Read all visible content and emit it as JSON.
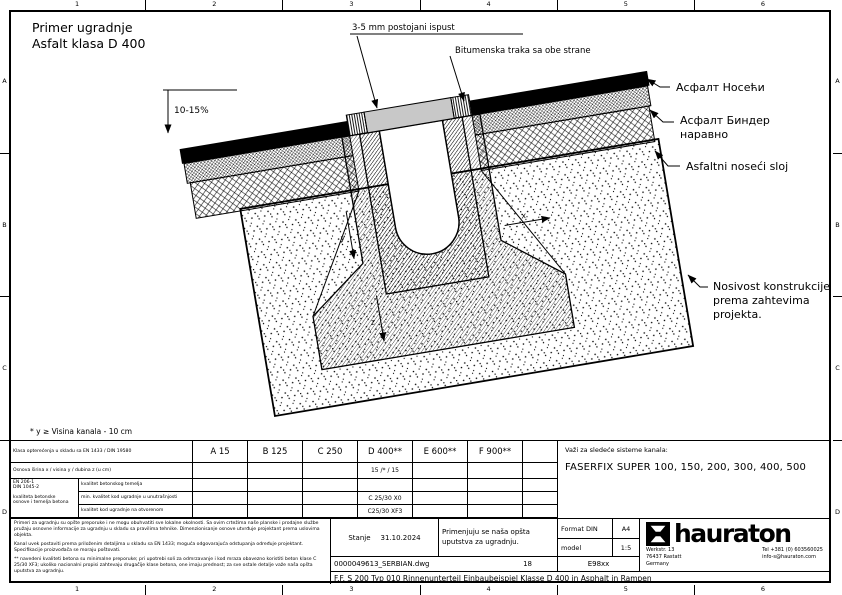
{
  "sheet": {
    "title_line1": "Primer ugradnje",
    "title_line2": "Asfalt klasa D 400",
    "footnote": "* y ≥ Visina kanala - 10 cm",
    "grid_columns": [
      "1",
      "2",
      "3",
      "4",
      "5",
      "6"
    ],
    "grid_rows": [
      "A",
      "B",
      "C",
      "D"
    ]
  },
  "annotations": {
    "expansion_gap": "3-5 mm postojani ispust",
    "bitumen_tape": "Bitumenska traka sa obe strane",
    "slope": "10-15%",
    "asphalt_surface": "Асфалт Носећи",
    "asphalt_binder_1": "Асфалт Биндер",
    "asphalt_binder_2": "наравно",
    "asphalt_base": "Asfaltni noseći sloj",
    "subgrade_1": "Nosivost konstrukcije",
    "subgrade_2": "prema zahtevima",
    "subgrade_3": "projekta.",
    "dim_x": "x",
    "dim_y": "y",
    "dim_z": "z"
  },
  "load_table": {
    "class_row_label": "Klasa opterećenja u skladu sa EN 1433 / DIN 19580",
    "classes": [
      "A 15",
      "B 125",
      "C 250",
      "D 400**",
      "E 600**",
      "F 900**"
    ],
    "dimension_row_label": "Osnova širina x / visina y / dubina z (u cm)",
    "dimension_value": "15 /* / 15",
    "norm_line1": "EN 206-1",
    "norm_line2": "DIN 1045-2",
    "norm_line3": "kvaliteta betonske",
    "norm_line4": "osnove i temelja betona",
    "sub_rows": [
      {
        "label": "kvalitet betonskog temelja",
        "value": ""
      },
      {
        "label": "min. kvalitet kod ugradnje u unutrašnjosti",
        "value": "C 25/30 X0"
      },
      {
        "label": "kvalitet kod ugradnje na otvorenom",
        "value": "C25/30 XF3"
      }
    ]
  },
  "systems_panel": {
    "heading": "Važi za sledeće sisteme kanala:",
    "systems": "FASERFIX SUPER  100, 150, 200, 300, 400, 500"
  },
  "title_block": {
    "fine_print": [
      "Primeri za ugradnju su opšte preporuke i ne mogu obuhvatiti sve lokalne okolnosti. Sa ovim crtežima naše planske i prodajne službe pružaju osnovne informacije za ugradnju u skladu sa pravilima tehnike. Dimenzionisanje osnove utvrđuje projektant prema uslovima objekta.",
      "Kanal uvek postaviti prema priloženim detaljima u skladu sa EN 1433; moguća odgovarajuća odstupanja određuje projektant. Specifikacije proizvođača se moraju poštovati.",
      "** navedeni kvaliteti betona su minimalne preporuke; pri upotrebi soli za odmrzavanje i kod mraza obavezno koristiti beton klase C 25/30 XF3; ukoliko nacionalni propisi zahtevaju drugačije klase betona, one imaju prednost; za sve ostale detalje važe naša opšta uputstva za ugradnju."
    ],
    "status_label": "Stanje",
    "status_date": "31.10.2024",
    "instruction": "Primenjuju se naša opšta uputstva za ugradnju.",
    "format_label": "Format DIN",
    "format_value": "A4",
    "scale_label": "model",
    "scale_value": "1:5",
    "file_name": "0000049613_SERBIAN.dwg",
    "sheet_number": "18",
    "drawing_code": "E98xx",
    "description": "F.F. S 200 Typ 010 Rinnenunterteil Einbaubeispiel Klasse D 400 in Asphalt in Rampen",
    "company": {
      "name": "hauraton",
      "address_line1": "Werkstr. 13",
      "address_line2": "76437 Rastatt",
      "address_line3": "Germany",
      "phone": "Tel +381 (0) 603560025",
      "email": "info-s@hauraton.com"
    }
  }
}
